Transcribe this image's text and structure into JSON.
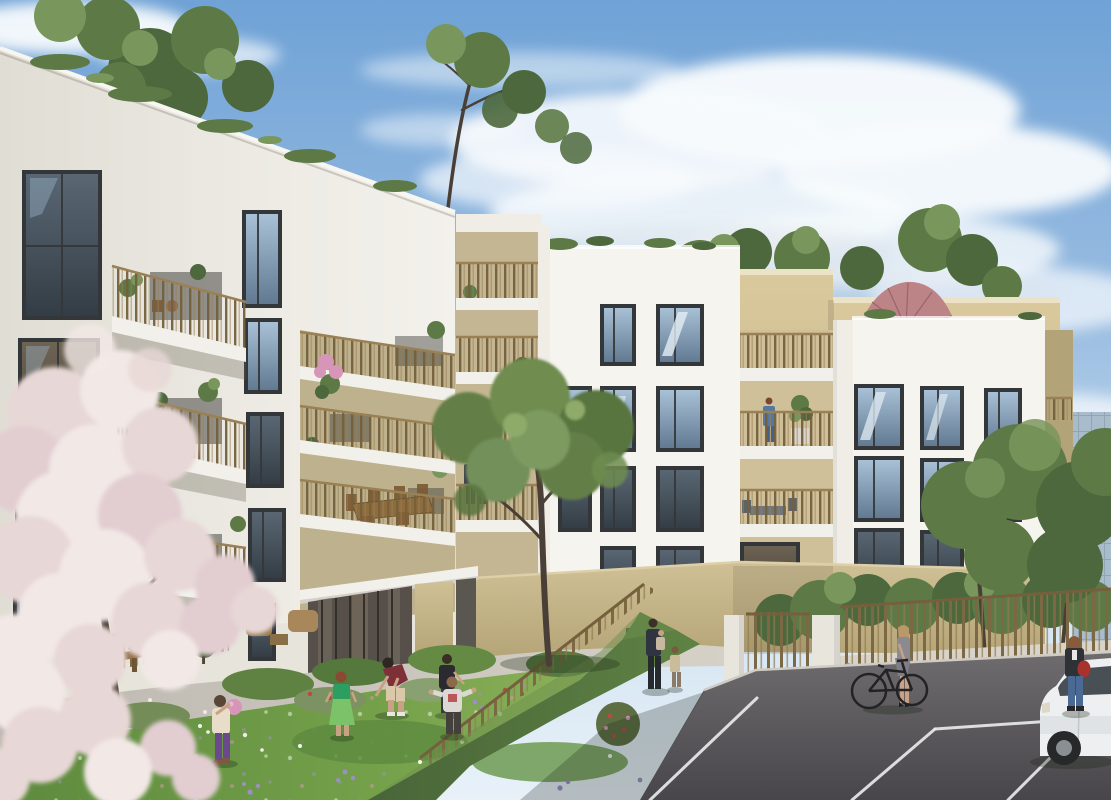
{
  "meta": {
    "type": "architectural-rendering",
    "subject": "modern residential apartment complex with courtyard meadow",
    "time_of_day": "daytime, sunny with scattered clouds",
    "canvas": {
      "width": 1111,
      "height": 800
    }
  },
  "palette": {
    "sky_top": "#6fa2d6",
    "sky_mid": "#9dbfe2",
    "sky_low": "#cfe2f1",
    "sky_horizon": "#e8f1f8",
    "cloud": "#f8fbfd",
    "cloud_shadow": "#d9e2ea",
    "facade_bright": "#f6f4ef",
    "facade_light": "#efede6",
    "facade_shade": "#e2dfd5",
    "window_frame": "#34373a",
    "glass_sky_top": "#aac3d8",
    "glass_sky_bot": "#5f7890",
    "glass_dark_top": "#5a6874",
    "glass_dark_bot": "#333c44",
    "glass_warm_top": "#6e6454",
    "glass_warm_bot": "#463f36",
    "railing": "#9a8055",
    "railing_dark": "#74603c",
    "beige_top": "#d9c99d",
    "beige_bot": "#bfae80",
    "loggia_inner": "#cfc09a",
    "loggia_shadow": "#b3a379",
    "stone_top": "#cfc096",
    "stone_bot": "#b2a274",
    "stone_line": "#a89868",
    "grass_dark": "#5d8a3e",
    "grass_mid": "#74a04a",
    "grass_light": "#8fb35c",
    "hedge_dark": "#486538",
    "hedge_light": "#5f8244",
    "foliage_dark": "#4c683c",
    "foliage_mid": "#5d7a46",
    "foliage_light": "#79965c",
    "blossom_light": "#f2e8e6",
    "blossom_mid": "#e7d7d6",
    "blossom_pink": "#e2cdd1",
    "trunk": "#4a3f36",
    "asphalt_top": "#6e6c6e",
    "asphalt_bot": "#48464a",
    "parking_line": "#e8eaea",
    "pavement": "#bdb9b1",
    "pavement_light": "#d5d1c7",
    "umbrella": "#bd8487",
    "umbrella_rib": "#96666a",
    "car_body": "#edeff1",
    "car_window": "#3a4148",
    "skin": "#c9a184",
    "flower_purple": "#9c8fc6",
    "flower_white": "#f2f5ec",
    "flower_pink": "#d795b8",
    "poppy_red": "#b84a40",
    "bag_red": "#a8322c",
    "shirt_red": "#7e3038",
    "dress_green": "#2d9e62",
    "dress_green_light": "#7cc268",
    "pants_purple": "#6a4a8c",
    "tower_glass": "#a9bccb",
    "tower_line": "#8aa0b0",
    "gate_white": "#e8e5dd",
    "wood": "#8a6844",
    "wood_light": "#a8854f"
  },
  "scene": {
    "sky": {
      "description": "blue sky with soft white cloud banks upper right and wisps top left"
    },
    "buildings": [
      {
        "name": "left-wing",
        "facade": "white render",
        "features": [
          "sloped planted parapet",
          "tall dark-framed windows",
          "three projecting balconies with bronze slat railings",
          "stacked loggias with dining furniture",
          "glazed entrance lobby with stone pillar"
        ]
      },
      {
        "name": "center-loggia-column",
        "facade": "white render with beige loggias",
        "features": [
          "couple standing on loggia",
          "balcony planting"
        ]
      },
      {
        "name": "center-block",
        "facade": "white render",
        "features": [
          "window grid reflecting sky",
          "rooftop grasses"
        ]
      },
      {
        "name": "rear-block",
        "facade": "beige render",
        "features": [
          "roof terrace",
          "rose parasol",
          "rooftop shrubs and trees"
        ]
      },
      {
        "name": "right-block",
        "facade": "white render",
        "features": [
          "3x3 window grid",
          "recessed side balconies"
        ]
      },
      {
        "name": "background-tower",
        "facade": "glass",
        "features": [
          "partially hidden by trees"
        ]
      }
    ],
    "ground": {
      "elements": [
        "wildflower meadow",
        "light concrete walkway",
        "ochre stone base wall",
        "diagonal hedge with bronze fence",
        "bronze boundary fence on low wall",
        "gate piers with slatted gate",
        "asphalt parking with white bay lines",
        "timber terrace fence and picnic bench",
        "clipped ball shrub"
      ]
    },
    "people": [
      {
        "name": "child-with-pink-ball",
        "location": "meadow left",
        "outfit": "beige top, purple leggings"
      },
      {
        "name": "girl-in-green-dress",
        "location": "meadow center"
      },
      {
        "name": "man-in-dark-red-tshirt",
        "location": "meadow, bending toward children"
      },
      {
        "name": "boy-in-dark-tshirt",
        "location": "meadow right"
      },
      {
        "name": "toddler-arms-out",
        "location": "meadow right",
        "outfit": "light shirt with red print"
      },
      {
        "name": "parent-carrying-child",
        "location": "walkway near entrance"
      },
      {
        "name": "small-child-standing",
        "location": "walkway near entrance"
      },
      {
        "name": "woman-with-bicycle",
        "location": "parking edge",
        "outfit": "grey dress"
      },
      {
        "name": "woman-with-red-handbag",
        "location": "beside white car",
        "outfit": "dark blazer, jeans"
      },
      {
        "name": "woman-standing-on-balcony",
        "location": "left wing, third level"
      },
      {
        "name": "person-seated-on-balcony",
        "location": "left wing, third level"
      },
      {
        "name": "couple-on-loggia",
        "location": "center loggia column"
      },
      {
        "name": "woman-on-upper-loggia",
        "location": "center-right loggia"
      }
    ],
    "vegetation": [
      {
        "name": "blossom-tree",
        "color": "pale pink-white",
        "location": "foreground left"
      },
      {
        "name": "meadow-tree",
        "location": "center courtyard"
      },
      {
        "name": "right-tree-group",
        "location": "in front of right block"
      },
      {
        "name": "rooftop-planting",
        "location": "all roof parapets"
      },
      {
        "name": "background-trees",
        "location": "behind left roofline"
      }
    ],
    "objects": [
      {
        "name": "rose-parasol",
        "location": "rear block roof terrace"
      },
      {
        "name": "bicycle",
        "color": "black"
      },
      {
        "name": "white-car",
        "location": "right edge, parking"
      },
      {
        "name": "picnic-bench",
        "location": "left terrace"
      },
      {
        "name": "balcony-dining-set",
        "location": "left wing loggia"
      }
    ]
  }
}
